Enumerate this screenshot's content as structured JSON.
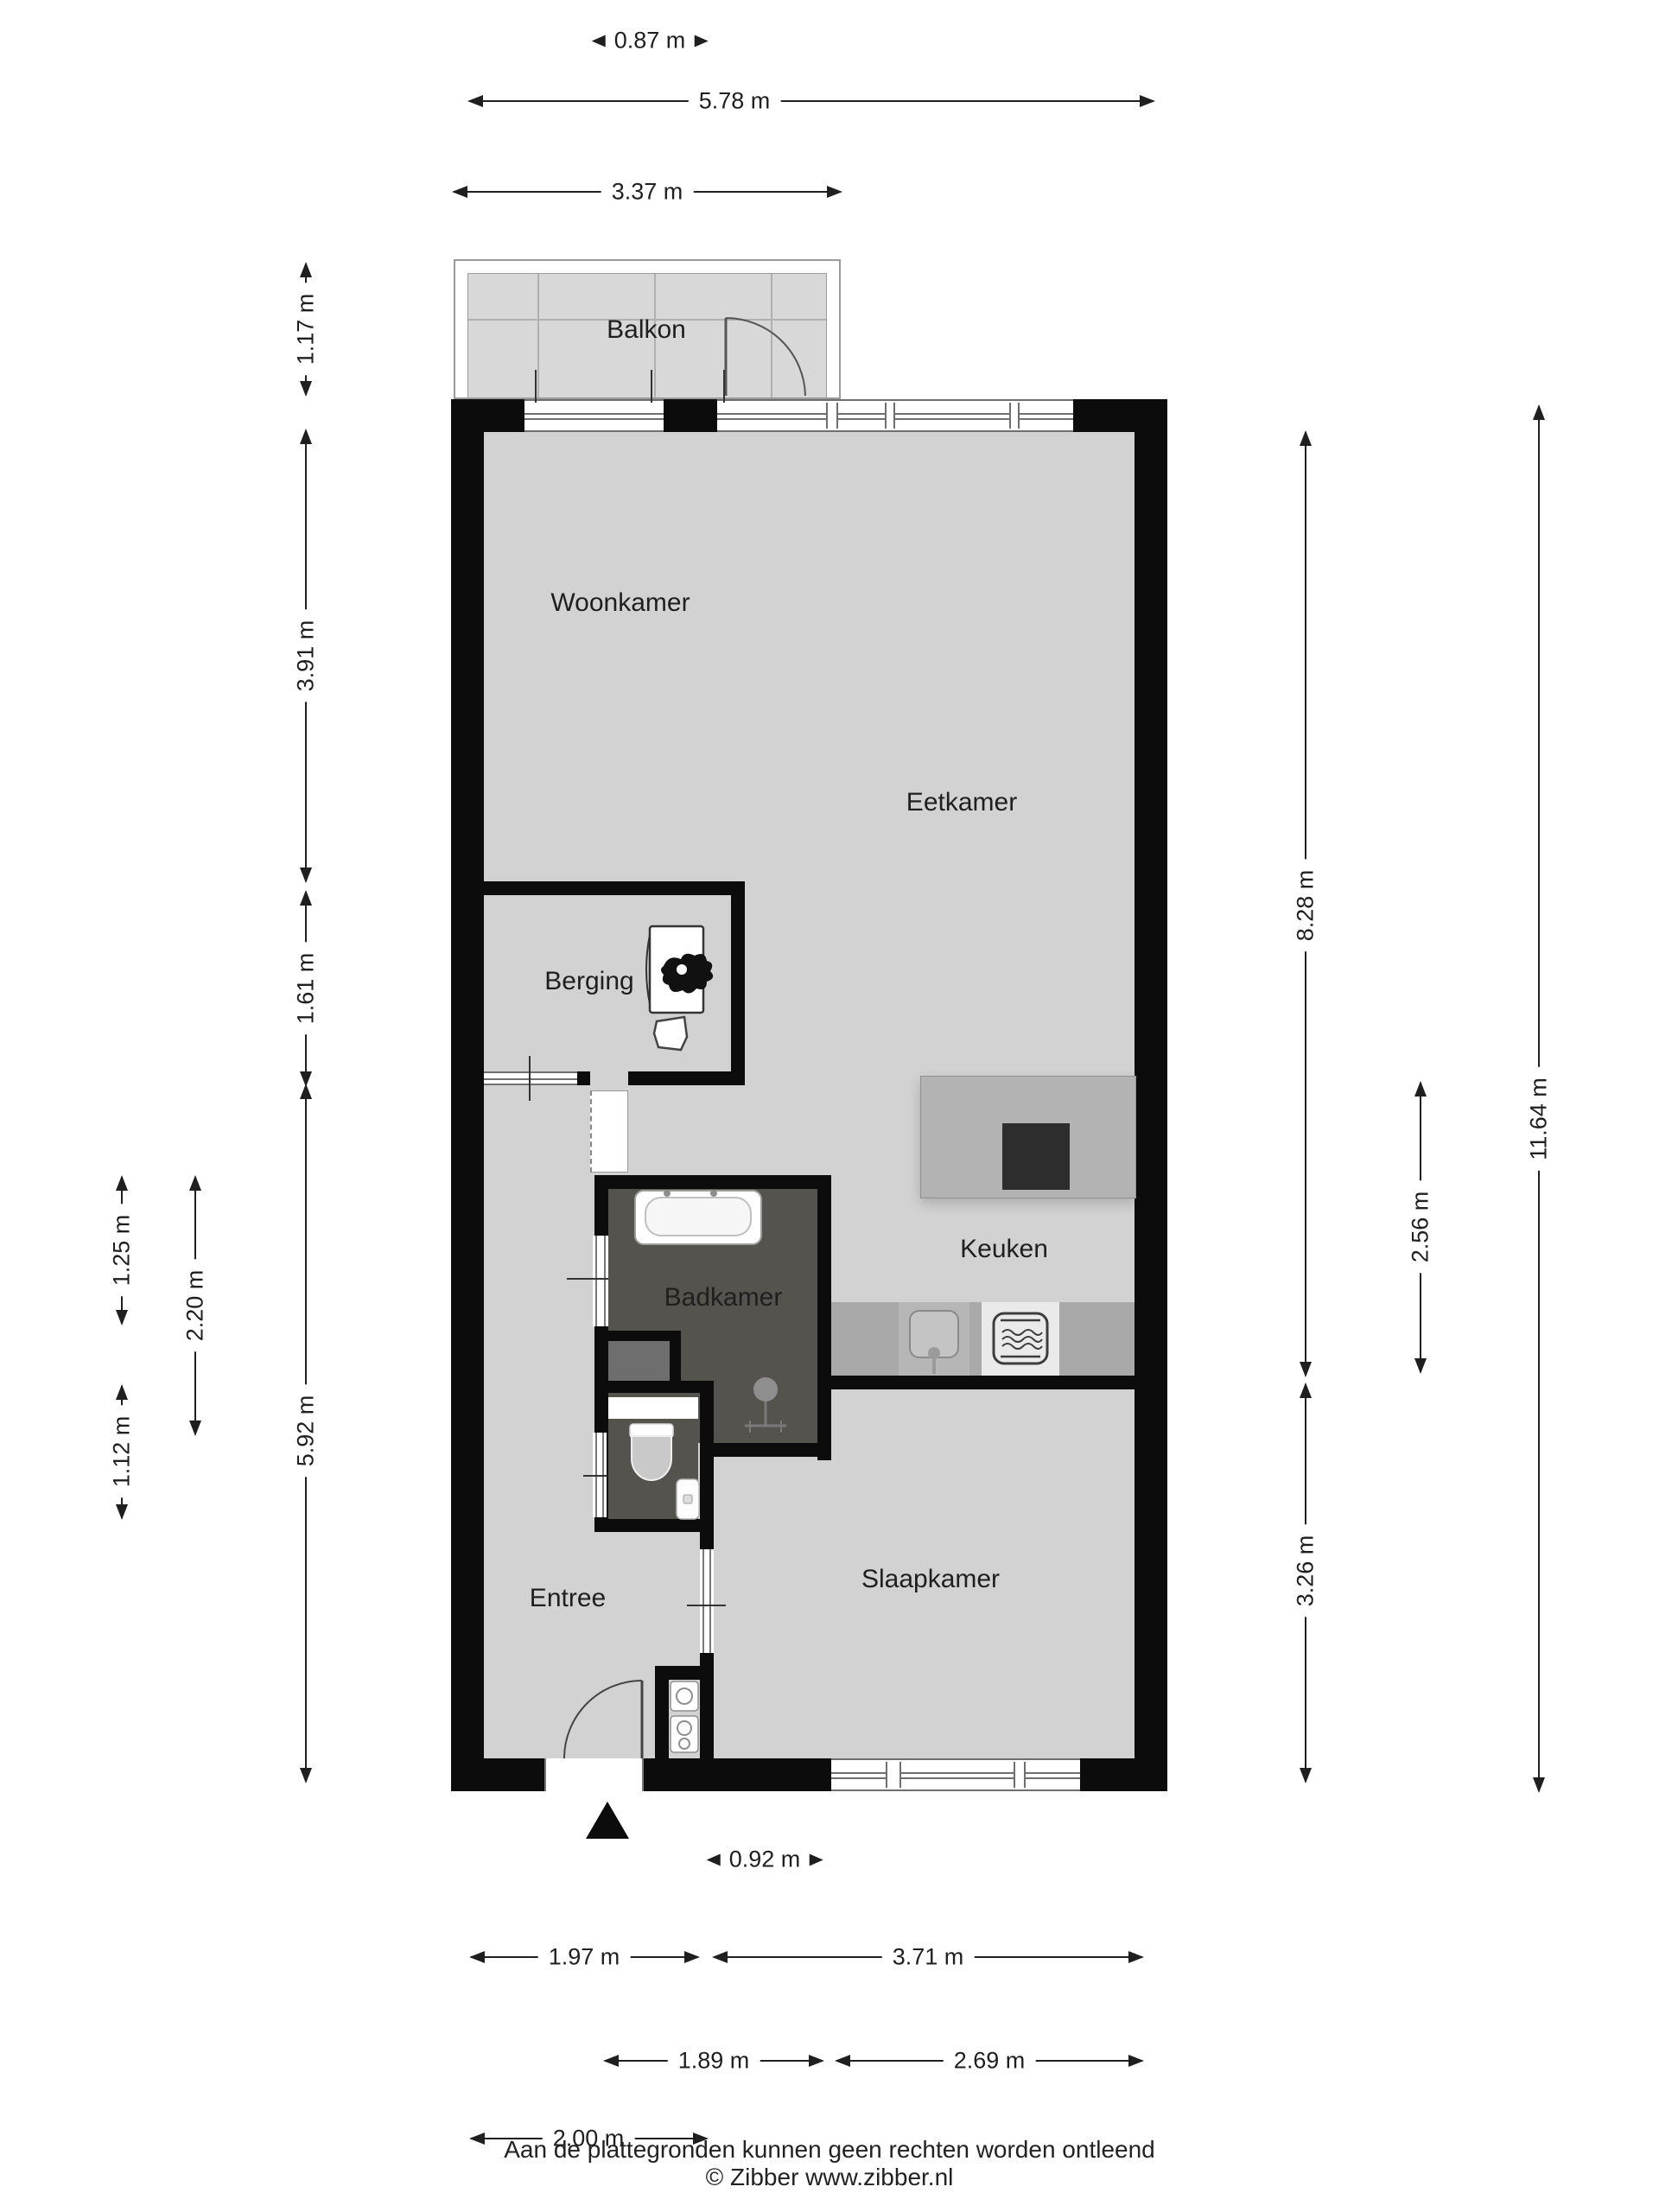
{
  "rooms": {
    "balkon": "Balkon",
    "woonkamer": "Woonkamer",
    "eetkamer": "Eetkamer",
    "berging": "Berging",
    "badkamer": "Badkamer",
    "keuken": "Keuken",
    "entree": "Entree",
    "slaapkamer": "Slaapkamer"
  },
  "dims": {
    "top_small": "0.87 m",
    "top_width": "5.78 m",
    "balcony_width": "3.37 m",
    "balcony_depth": "1.17 m",
    "woonkamer_h": "3.91 m",
    "berging_h": "1.61 m",
    "lower_left_h": "5.92 m",
    "badkamer_upper": "1.25 m",
    "badkamer_h": "2.20 m",
    "toilet_h": "1.12 m",
    "right_upper": "8.28 m",
    "keuken_h": "2.56 m",
    "slaapkamer_h": "3.26 m",
    "total_h": "11.64 m",
    "door_w": "0.92 m",
    "bottom_l1": "1.97 m",
    "bottom_r1": "3.71 m",
    "bottom_l2": "1.89 m",
    "bottom_r2": "2.69 m",
    "bottom_l3": "2.00 m"
  },
  "footer": {
    "line1": "Aan de plattegronden kunnen geen rechten worden ontleend",
    "line2": "© Zibber www.zibber.nl"
  },
  "colors": {
    "wall": "#0c0c0c",
    "floor": "#d2d2d2",
    "wet_floor": "#55534d",
    "closet": "#6e6e6e",
    "counter": "#a9a9a9",
    "island": "#b3b3b3",
    "cooktop": "#2d2d2d",
    "balcony_floor": "#d8d8d8",
    "ink": "#1f1f1f"
  }
}
